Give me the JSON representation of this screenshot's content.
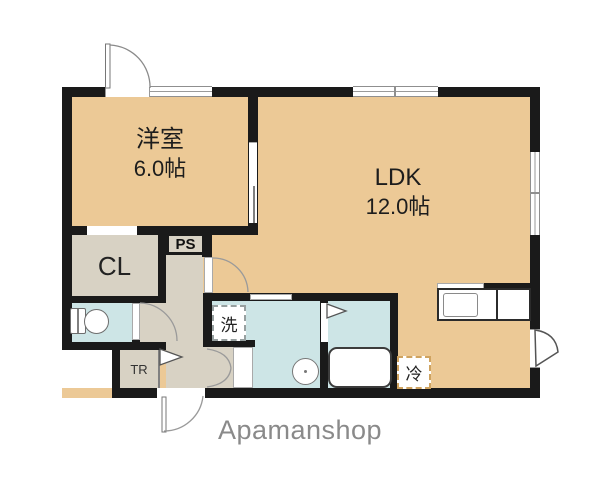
{
  "brand": "Apamanshop",
  "rooms": {
    "western": {
      "name": "洋室",
      "area": "6.0帖"
    },
    "ldk": {
      "name": "LDK",
      "area": "12.0帖"
    },
    "closet": {
      "label": "CL"
    },
    "pipe_space": {
      "label": "PS"
    },
    "trunk": {
      "label": "TR"
    }
  },
  "fixtures": {
    "washer": {
      "label": "洗"
    },
    "fridge": {
      "label": "冷"
    }
  },
  "colors": {
    "room_tan": "#ecc996",
    "room_gray": "#d8d2c4",
    "room_blue": "#cde5e6",
    "wall": "#1a1a1a",
    "brand_gray": "#8a8a8a",
    "fridge_dash": "#cfa360"
  }
}
